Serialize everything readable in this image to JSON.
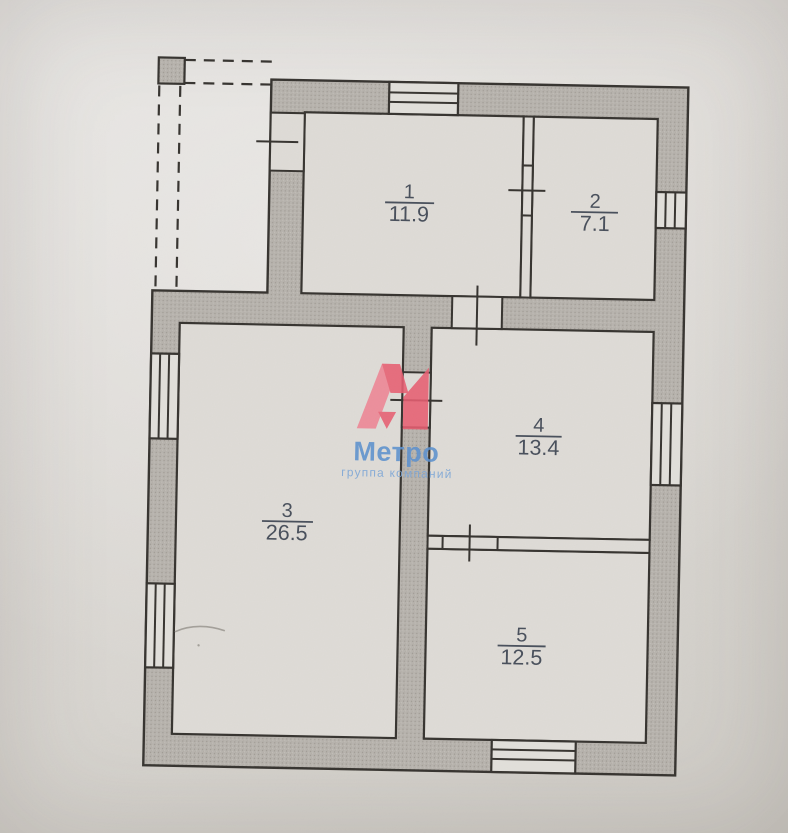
{
  "plan": {
    "kind": "apartment floor plan (scanned photo)",
    "rooms": [
      {
        "number": "1",
        "area": "11.9"
      },
      {
        "number": "2",
        "area": "7.1"
      },
      {
        "number": "3",
        "area": "26.5"
      },
      {
        "number": "4",
        "area": "13.4"
      },
      {
        "number": "5",
        "area": "12.5"
      }
    ]
  },
  "watermark": {
    "brand": "Метро",
    "tagline": "группа компаний",
    "logo_red": "#e85d70",
    "logo_red_light": "#ee8494",
    "text_blue": "#5b90ce",
    "tagline_blue": "#7aa5d7"
  },
  "palette": {
    "paper": "#dedbd6",
    "wall_fill": "#b7b3ad",
    "line": "#35322e",
    "label_text": "#474e5a"
  }
}
